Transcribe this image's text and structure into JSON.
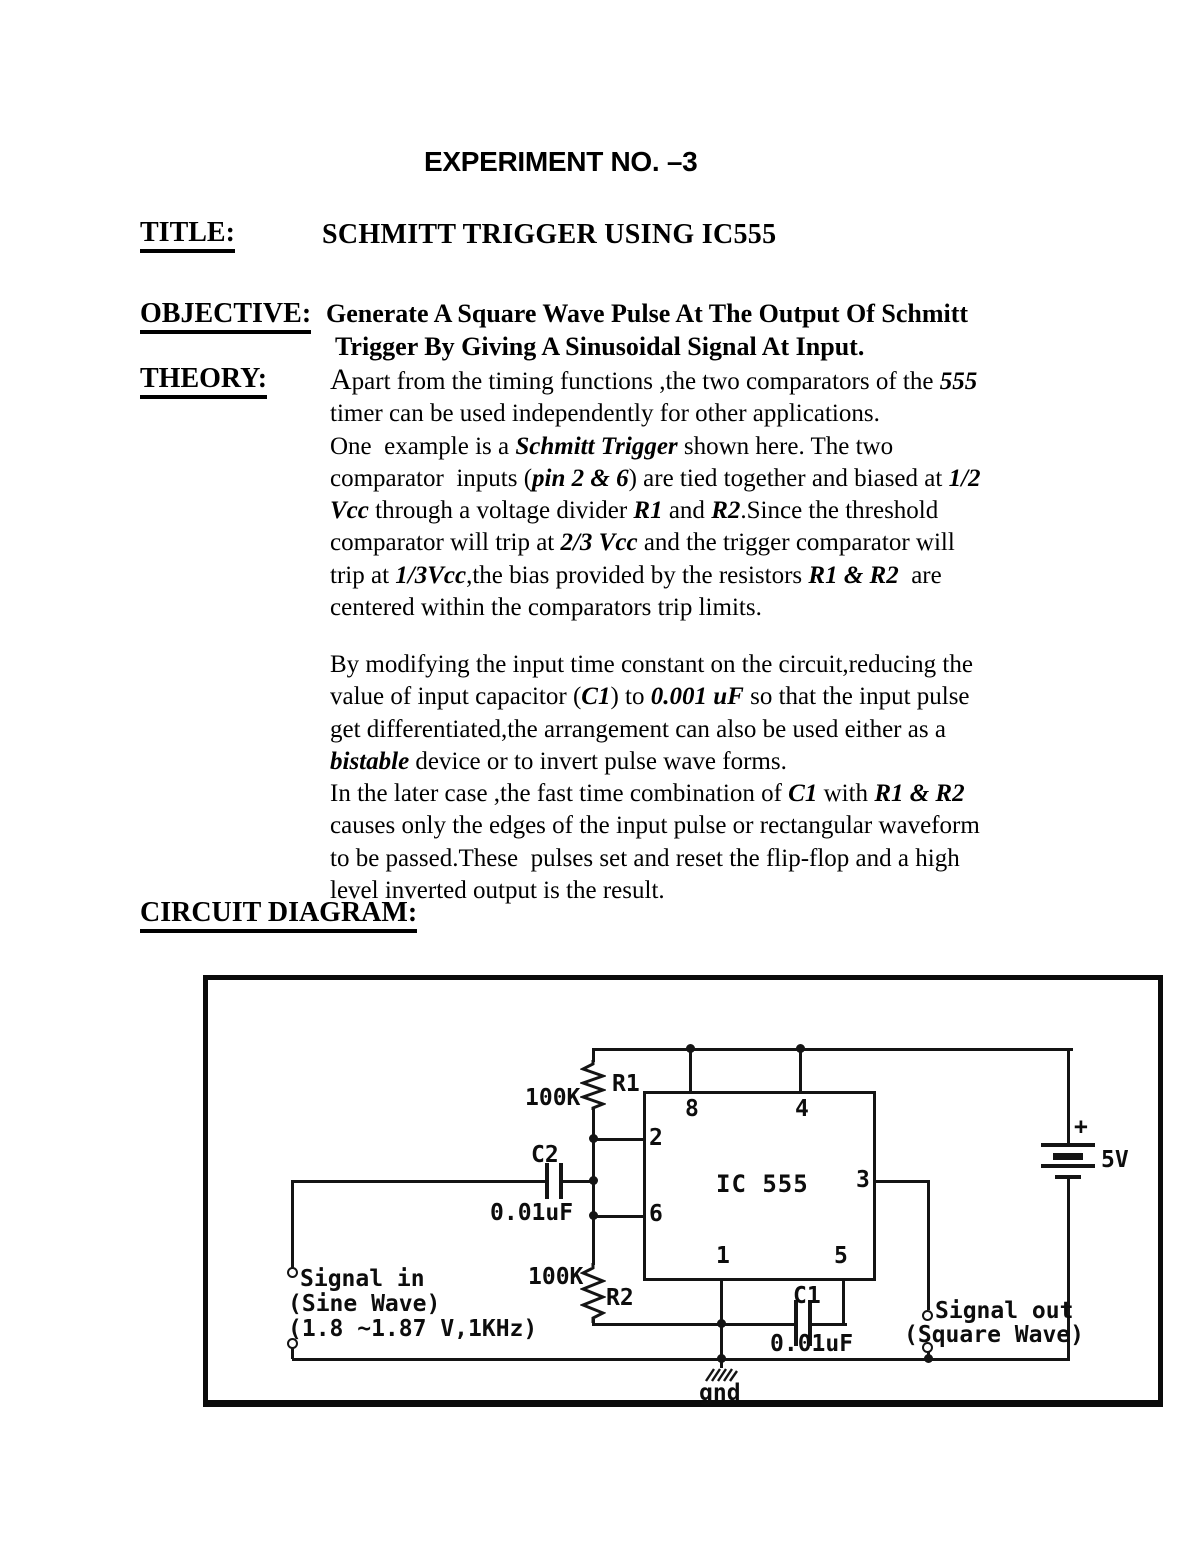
{
  "header": {
    "title": "EXPERIMENT NO. –3"
  },
  "sections": {
    "title": {
      "label": "TITLE:",
      "text": "SCHMITT TRIGGER USING IC555"
    },
    "objective": {
      "label": "OBJECTIVE:",
      "lines": [
        "Generate A Square Wave Pulse At The Output Of Schmitt",
        "Trigger By Giving A Sinusoidal Signal At Input."
      ]
    },
    "theory": {
      "label": "THEORY:",
      "para1": [
        [
          {
            "t": "A",
            "s": "lg"
          },
          {
            "t": "part from the timing functions ,the two comparators of the "
          },
          {
            "t": "555",
            "s": "bi"
          }
        ],
        [
          {
            "t": "timer can be used independently for other applications."
          }
        ],
        [
          {
            "t": "One  example is a "
          },
          {
            "t": "Schmitt Trigger",
            "s": "bi"
          },
          {
            "t": " shown here. The two"
          }
        ],
        [
          {
            "t": "comparator  inputs ("
          },
          {
            "t": "pin 2 & 6",
            "s": "bi"
          },
          {
            "t": ") are tied together and biased at "
          },
          {
            "t": "1/2",
            "s": "bi"
          }
        ],
        [
          {
            "t": "Vcc",
            "s": "bi"
          },
          {
            "t": " through a voltage divider "
          },
          {
            "t": "R1",
            "s": "bi"
          },
          {
            "t": " and "
          },
          {
            "t": "R2",
            "s": "bi"
          },
          {
            "t": ".Since the threshold"
          }
        ],
        [
          {
            "t": "comparator will trip at "
          },
          {
            "t": "2/3 Vcc",
            "s": "bi"
          },
          {
            "t": " and the trigger comparator will"
          }
        ],
        [
          {
            "t": "trip at "
          },
          {
            "t": "1/3Vcc",
            "s": "bi"
          },
          {
            "t": ",the bias provided by the resistors "
          },
          {
            "t": "R1 & R2",
            "s": "bi"
          },
          {
            "t": "  are"
          }
        ],
        [
          {
            "t": "centered within the comparators trip limits."
          }
        ]
      ],
      "para2": [
        [
          {
            "t": "By modifying the input time constant on the circuit,reducing the"
          }
        ],
        [
          {
            "t": "value of input capacitor ("
          },
          {
            "t": "C1",
            "s": "bi"
          },
          {
            "t": ") to "
          },
          {
            "t": "0.001 uF",
            "s": "bi"
          },
          {
            "t": " so that the input pulse"
          }
        ],
        [
          {
            "t": "get differentiated,the arrangement can also be used either as a"
          }
        ],
        [
          {
            "t": "bistable",
            "s": "bi"
          },
          {
            "t": " device or to invert pulse wave forms."
          }
        ],
        [
          {
            "t": "In the later case ,the fast time combination of "
          },
          {
            "t": "C1",
            "s": "bi"
          },
          {
            "t": " with "
          },
          {
            "t": "R1 & R2",
            "s": "bi"
          }
        ],
        [
          {
            "t": "causes only the edges of the input pulse or rectangular waveform"
          }
        ],
        [
          {
            "t": "to be passed.These  pulses set and reset the flip-flop and a high"
          }
        ],
        [
          {
            "t": "level inverted output is the result."
          }
        ]
      ]
    },
    "circuit": {
      "label": "CIRCUIT DIAGRAM:"
    }
  },
  "diagram": {
    "ic": {
      "label": "IC 555",
      "pins": {
        "top_left": "8",
        "top_right": "4",
        "left_upper": "2",
        "left_lower": "6",
        "right": "3",
        "bottom_left": "1",
        "bottom_right": "5"
      }
    },
    "r1": {
      "value": "100K",
      "name": "R1"
    },
    "r2": {
      "value": "100K",
      "name": "R2"
    },
    "c2": {
      "name": "C2",
      "value": "0.01uF"
    },
    "c1": {
      "name": "C1",
      "value": "0.01uF"
    },
    "battery": {
      "plus": "+",
      "value": "5V"
    },
    "signal_in": {
      "line1": "Signal in",
      "line2": "(Sine Wave)",
      "line3": "(1.8 ~1.87 V,1KHz)"
    },
    "signal_out": {
      "line1": "Signal out",
      "line2": "(Square Wave)"
    },
    "ground": "gnd"
  },
  "colors": {
    "ink": "#141414",
    "paper": "#ffffff"
  }
}
